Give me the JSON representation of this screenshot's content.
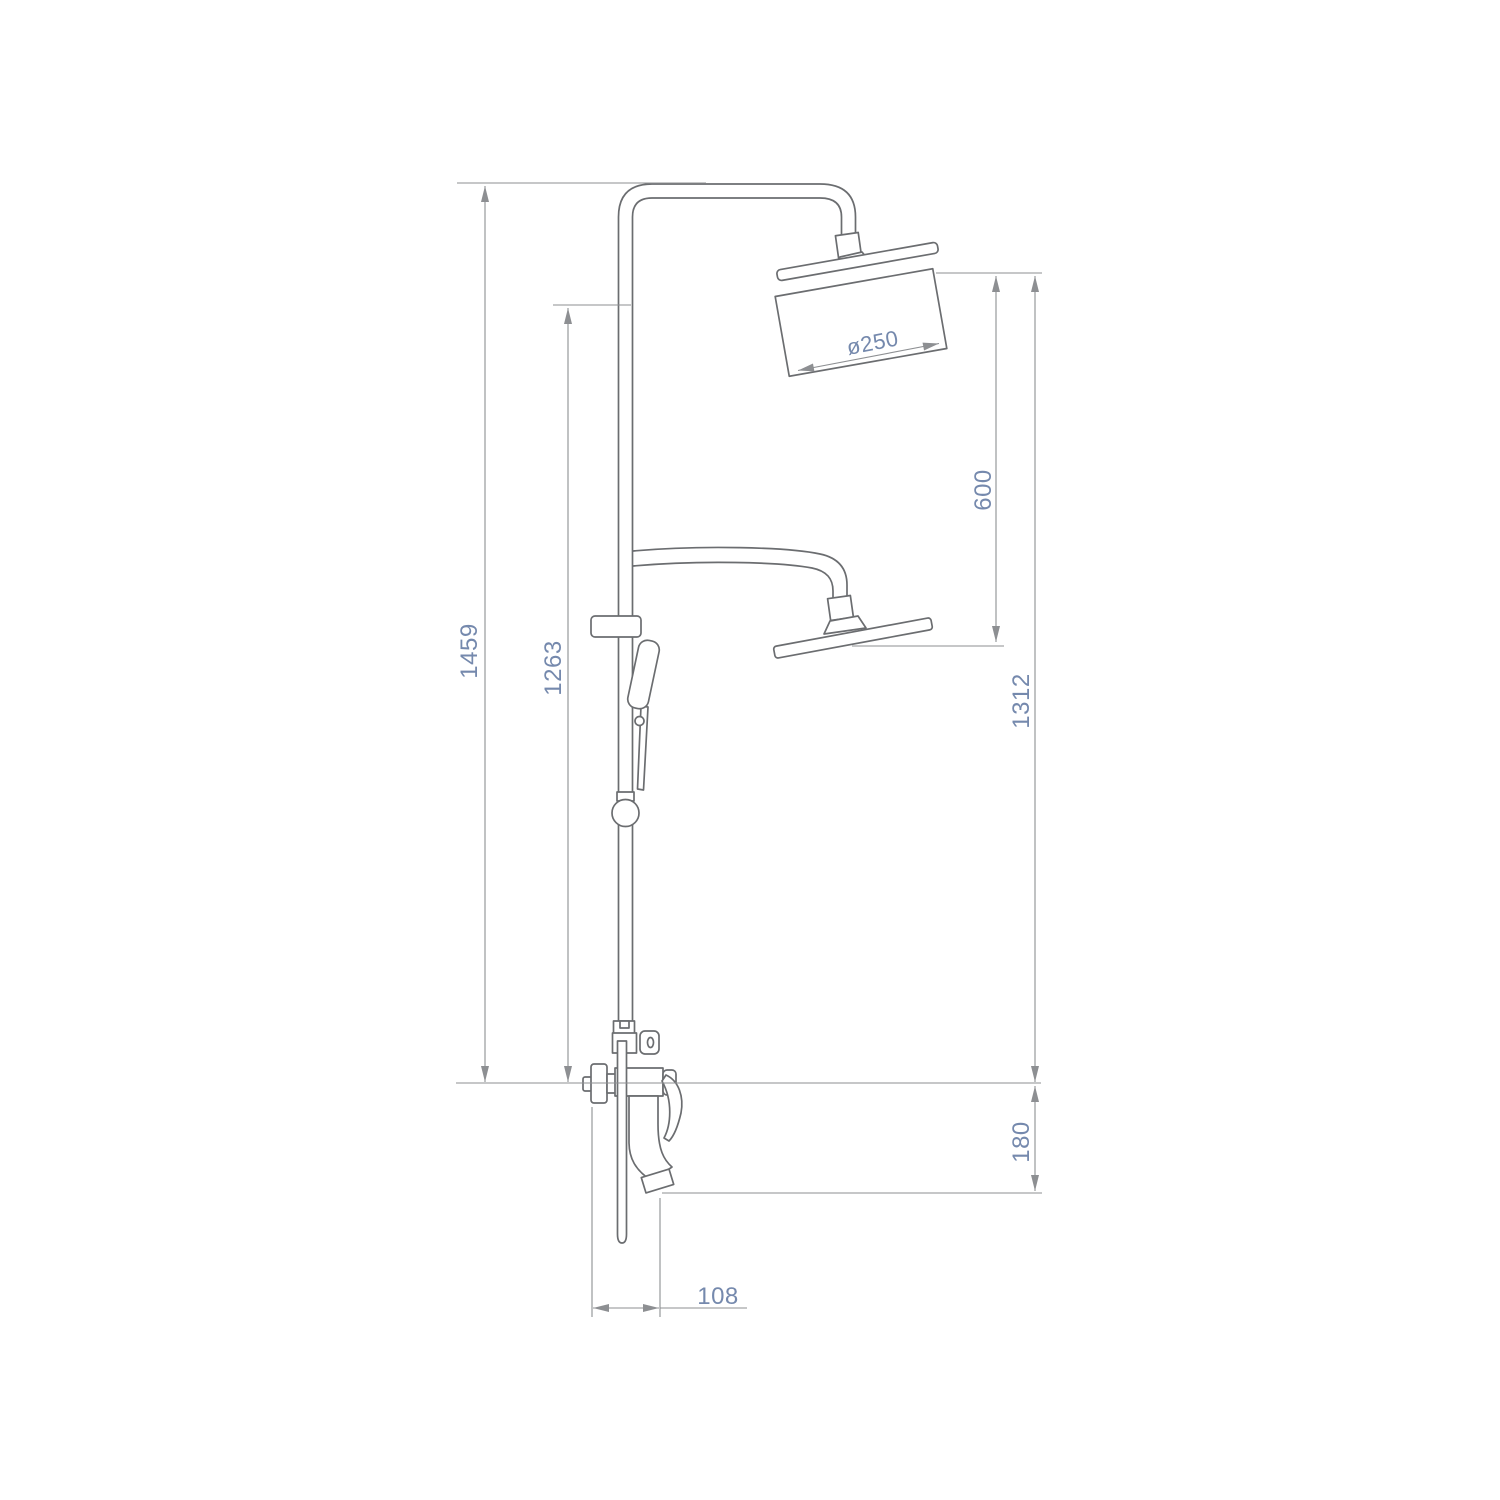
{
  "dimensions": {
    "overall_height": "1459",
    "riser_height": "1263",
    "overhead_diameter": "ø250",
    "head_to_handset_arm": "600",
    "lower_arm_height": "1312",
    "spout_drop": "180",
    "spout_reach": "108"
  },
  "colors": {
    "outline": "#6b6d70",
    "dimension": "#8d8f92",
    "label": "#7589ad",
    "background": "#ffffff"
  }
}
